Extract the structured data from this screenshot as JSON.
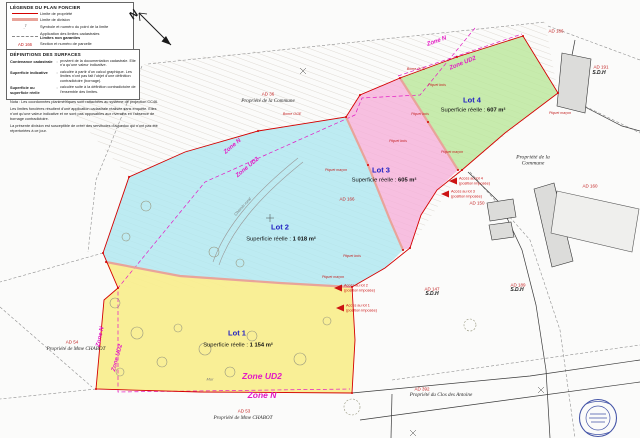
{
  "colors": {
    "lot1": "#f8ee8d",
    "lot2": "#aee7f0",
    "lot3": "#f6b0da",
    "lot4": "#bae79a",
    "property_limit": "#d40000",
    "division_limit": "#e8a49a",
    "zone_label": "#e318c4",
    "parcel_code": "#c32222",
    "stamp": "#4656a8"
  },
  "legend": {
    "title": "LÉGENDE DU PLAN FONCIER",
    "point_symbol": "7",
    "items": [
      {
        "label": "Limite de propriété"
      },
      {
        "label": "Limite de division"
      },
      {
        "label": "Symbole et numéro du point de la limite"
      },
      {
        "label": "Application des limites cadastrales",
        "label2": "Limites non garanties"
      },
      {
        "code": "AD 166",
        "label": "Section et numéro de parcelle"
      }
    ]
  },
  "definitions": {
    "title": "DÉFINITIONS DES SURFACES",
    "items": [
      {
        "term": "Contenance cadastrale",
        "def": "provient de la documentation cadastrale. Elle n'a qu'une valeur indicative."
      },
      {
        "term": "Superficie indicative",
        "def": "calculée à partir d'un calcul graphique. Les limites n'ont pas fait l'objet d'une définition contradictoire (bornage)."
      },
      {
        "term": "Superficie ou superficie réelle",
        "def": "calculée suite à la définition contradictoire de l'ensemble des limites."
      }
    ]
  },
  "nota": {
    "p1": "Nota : Les coordonnées planimétriques sont rattachées au système de projection CC46.",
    "p2": "Les limites foncières résultent d'une application cadastrale réalisée sans enquête. Elles n'ont qu'une valeur indicative et ne sont pas opposables aux riverains en l'absence de bornage contradictoire.",
    "p3": "La présente division est susceptible de créer des servitudes d'aqueduc qui n'ont pas été répertoriées à ce jour."
  },
  "north": {
    "label": "N"
  },
  "lots": [
    {
      "title": "Lot 1",
      "area_label": "Superficie réelle :",
      "area_value": "1 154 m²"
    },
    {
      "title": "Lot 2",
      "area_label": "Superficie réelle :",
      "area_value": "1 018 m²"
    },
    {
      "title": "Lot 3",
      "area_label": "Superficie réelle :",
      "area_value": "605 m²"
    },
    {
      "title": "Lot 4",
      "area_label": "Superficie réelle :",
      "area_value": "607 m²"
    }
  ],
  "parcels": [
    {
      "code": "AD 36",
      "owner": "Propriété de la Commune"
    },
    {
      "code": "AD 186"
    },
    {
      "code": "AD 191",
      "owner": "S.D.H"
    },
    {
      "owner": "Propriété de la Commune"
    },
    {
      "code": "AD 160"
    },
    {
      "code": "AD 166"
    },
    {
      "code": "AD 150"
    },
    {
      "code": "AD 147",
      "owner": "S.D.H"
    },
    {
      "code": "AD 189",
      "owner": "S.D.H"
    },
    {
      "code": "AD 54",
      "owner": "Propriété de Mme CHABOT"
    },
    {
      "code": "AD 53",
      "owner": "Propriété de Mme CHABOT"
    },
    {
      "code": "AD 392",
      "owner": "Propriété du Clos des Antoine"
    }
  ],
  "zones": [
    {
      "text": "Zone N"
    },
    {
      "text": "Zone UD2"
    },
    {
      "text": "Zone N"
    },
    {
      "text": "Zone UD2"
    },
    {
      "text": "Zone N"
    },
    {
      "text": "Zone UD2"
    },
    {
      "text": "Zone UD2"
    },
    {
      "text": "Zone N"
    }
  ],
  "access": [
    {
      "line1": "Accès au lot 4",
      "line2": "(position imposée)"
    },
    {
      "line1": "Accès au lot 3",
      "line2": "(position imposée)"
    },
    {
      "line1": "Accès au lot 2",
      "line2": "(position imposée)"
    },
    {
      "line1": "Accès au lot 1",
      "line2": "(position imposée)"
    }
  ],
  "stakes": [
    {
      "text": "Piquet bois"
    },
    {
      "text": "Piquet maçon"
    },
    {
      "text": "Piquet bois"
    },
    {
      "text": "Piquet maçon"
    },
    {
      "text": "Piquet bois"
    },
    {
      "text": "Piquet maçon"
    },
    {
      "text": "Piquet bois"
    },
    {
      "text": "Piquet maçon"
    },
    {
      "text": "Borne OGE"
    },
    {
      "text": "Borne OGE"
    }
  ],
  "annotations": {
    "chemin": "Chemin rural",
    "mur": "Mur"
  }
}
